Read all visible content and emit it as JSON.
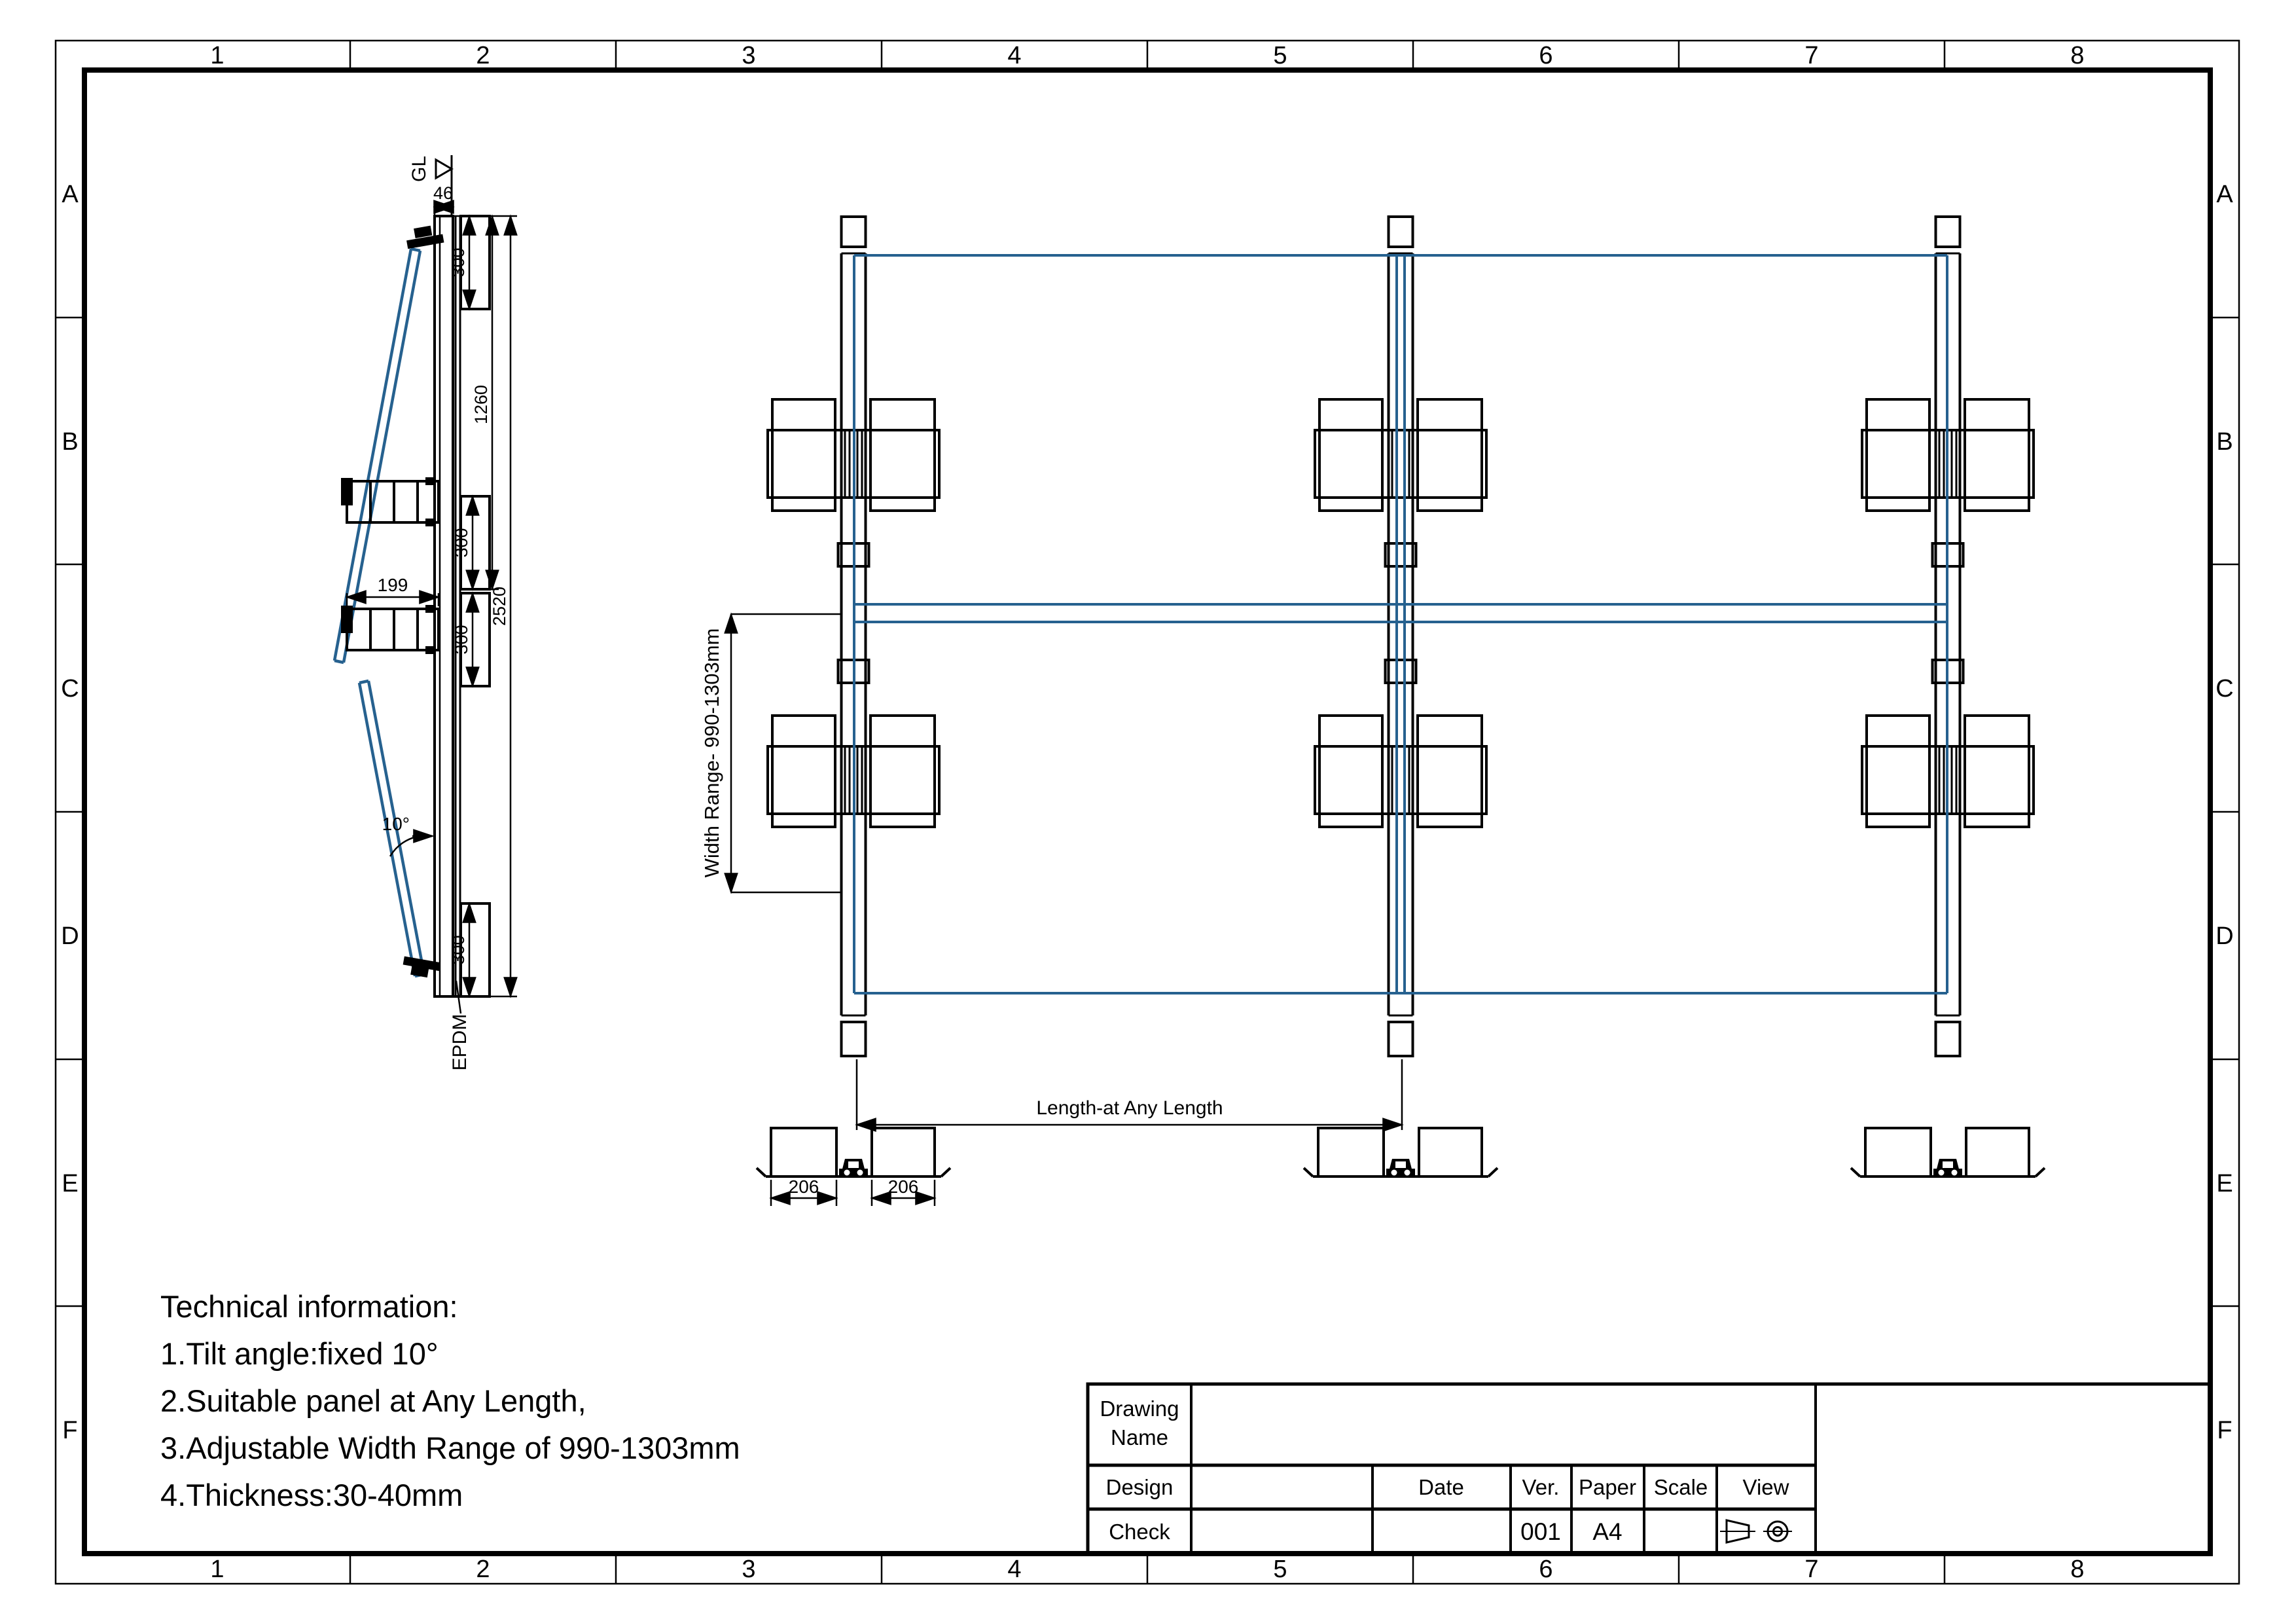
{
  "sheet": {
    "cols": [
      "1",
      "2",
      "3",
      "4",
      "5",
      "6",
      "7",
      "8"
    ],
    "rows": [
      "A",
      "B",
      "C",
      "D",
      "E",
      "F"
    ]
  },
  "side_view": {
    "gl": "GL",
    "d46": "46",
    "d300": [
      "300",
      "300",
      "300",
      "300"
    ],
    "d1260": "1260",
    "d2520": "2520",
    "d199": "199",
    "angle": "10°",
    "epdm": "EPDM"
  },
  "top_view": {
    "width_range": "Width Range- 990-1303mm",
    "length": "Length-at Any Length"
  },
  "details": {
    "d206": [
      "206",
      "206"
    ]
  },
  "tech_info": {
    "title": "Technical information:",
    "line1": "1.Tilt angle:fixed 10°",
    "line2": "2.Suitable panel at Any Length,",
    "line3": "3.Adjustable Width Range of 990-1303mm",
    "line4": "4.Thickness:30-40mm"
  },
  "title_block": {
    "drawing_label_1": "Drawing",
    "drawing_label_2": "Name",
    "design_label": "Design",
    "check_label": "Check",
    "date_label": "Date",
    "ver_label": "Ver.",
    "paper_label": "Paper",
    "scale_label": "Scale",
    "view_label": "View",
    "ver_value": "001",
    "paper_value": "A4"
  },
  "colors": {
    "line": "#000000",
    "panel_blue": "#26618f"
  }
}
